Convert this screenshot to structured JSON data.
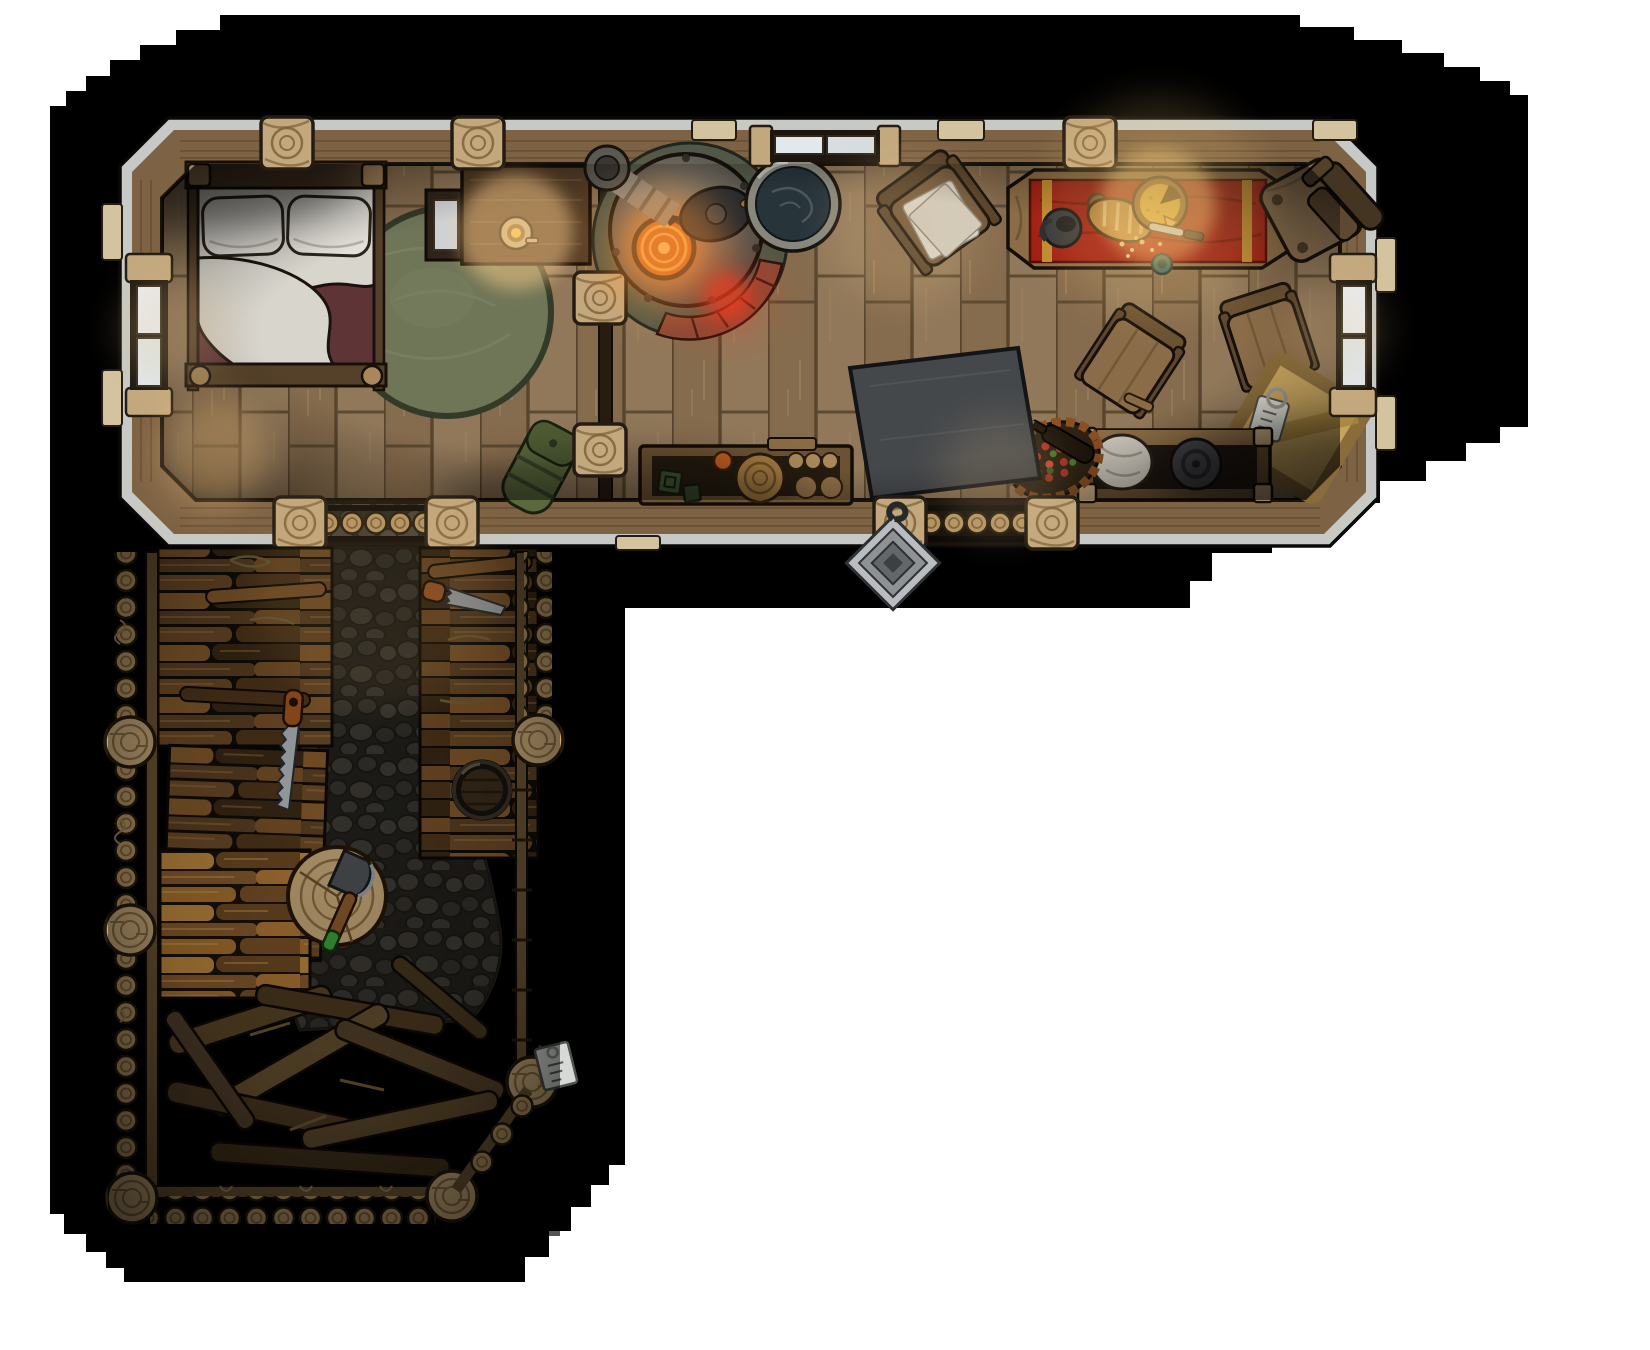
{
  "scene": {
    "kind": "top-down fantasy battlemap",
    "setting": "log cabin with attached firewood yard",
    "rooms": [
      {
        "name": "bedroom",
        "contents": [
          "double-bed",
          "round-rug",
          "nightstand",
          "writing-desk",
          "candlestick"
        ]
      },
      {
        "name": "main-room",
        "contents": [
          "iron-stove",
          "stove-chimney",
          "kettle",
          "wash-basin",
          "armchair-with-papers",
          "dining-table-red-runner",
          "jug",
          "bread-loaf",
          "cheese-wheel",
          "knife",
          "chairs",
          "storage-crate",
          "storage-bench",
          "harvest-basket",
          "slate-table",
          "kitchen-counter",
          "duffel-bag"
        ]
      },
      {
        "name": "wood-yard",
        "contents": [
          "stone-path",
          "firewood-stacks",
          "hand-saw",
          "hand-saw",
          "water-barrel",
          "chopping-block",
          "axe",
          "branch-pile",
          "log-fence",
          "plank-fence",
          "hanging-sign"
        ]
      }
    ],
    "doors": [
      "south-log-door",
      "yard-log-door"
    ],
    "windows": [
      "north-window",
      "west-window",
      "east-window"
    ],
    "decorations": [
      "iron-door-charm",
      "ember-glow-on-floor"
    ]
  },
  "palette": {
    "page": "#ffffff",
    "void": "#000000",
    "wall_wood": "#7d6243",
    "wall_highlight": "#c6c9c5",
    "log_post": "#c3a87e",
    "floor": "#8b7252",
    "floor_seam": "#57452e",
    "divider": "#261c10",
    "rug": "#6f7557",
    "rug_edge": "#343a28",
    "bed_frame": "#55412a",
    "linen": "#d8d5cd",
    "pillow": "#e3e0d9",
    "blanket": "#5e3436",
    "desk": "#503a25",
    "nightstand": "#2f241a",
    "candle_gold": "#f2c84b",
    "stove_metal": "#5f5b55",
    "burner": "#d06a22",
    "flame_ring": "#f8a84a",
    "brick": "#8a4836",
    "hearth_stone": "#515848",
    "basin_rim": "#87877d",
    "basin_water": "#27343a",
    "kettle": "#26292e",
    "chair_wood": "#8a6c48",
    "chair_dark": "#443422",
    "cloth_red": "#a01d12",
    "cloth_trim": "#c08a2e",
    "bread": "#b5823f",
    "cheese": "#e8b83c",
    "jug": "#323539",
    "slate_table": "#45484b",
    "crate": "#c6a45e",
    "bench": "#6b5233",
    "sack": "#cbc6ba",
    "pot_lid": "#46464a",
    "basket_weave": "#8a5022",
    "berries": "#b23222",
    "greens": "#4c7a2e",
    "duffel": "#5a683c",
    "stone": "#4f4b43",
    "grout": "#2e2b26",
    "firewood_dark": "#51371c",
    "firewood_mid": "#6e4c28",
    "firewood_amber": "#a8742f",
    "fence_rail": "#6b5434",
    "block": "#c6a879",
    "axe_head": "#4e5154",
    "axe_grip": "#3da03d",
    "saw_steel": "#b4bac0",
    "saw_handle": "#a5571f",
    "barrel_wood": "#3c2f1d",
    "charm_metal": "#b9bdbf",
    "sign": "#d6d9d6",
    "glow_warm": "#ffce8a",
    "glow_fire": "#ff9a3e",
    "glow_ember": "#ff3a1e"
  }
}
